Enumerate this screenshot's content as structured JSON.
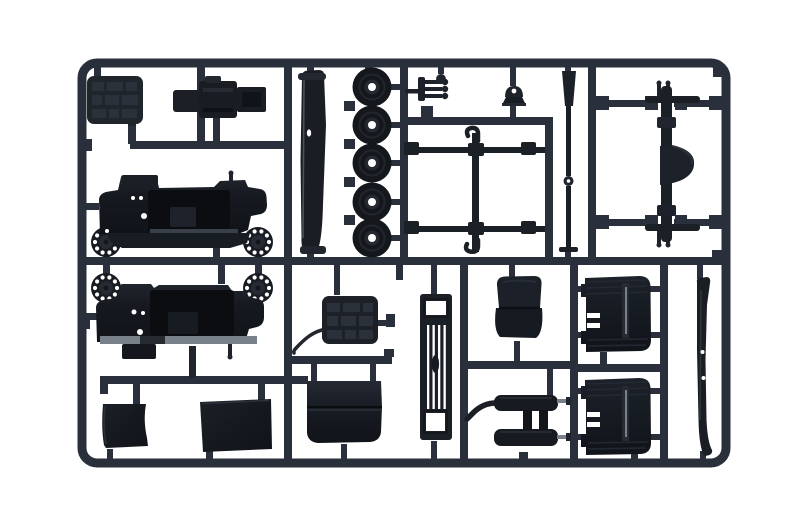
{
  "image": {
    "kind": "product photograph",
    "description": "Injection-moulded plastic model kit sprue (parts tree) in dark grey styrene containing truck parts, shot on a white background",
    "text_visible": "none"
  },
  "colors": {
    "background": "#ffffff",
    "runner": "#2a303b",
    "part_dark": "#16191f",
    "part_mid": "#20252d",
    "part_soft": "#2b313a",
    "edge_light": "#78808a",
    "steel_light": "#8d949d",
    "interior_shadow": "#0b0d10",
    "hole": "#ffffff"
  },
  "sprue": {
    "material": "dark grey styrene plastic",
    "frame_shape": "rounded rectangle with internal runner grid",
    "parts": [
      {
        "id": "tread-plate-panel",
        "label": "textured tread-plate panel",
        "count": 1
      },
      {
        "id": "engine-block",
        "label": "engine block assembly",
        "count": 1
      },
      {
        "id": "windscreen-frame",
        "label": "long curved windscreen/panel strip",
        "count": 1
      },
      {
        "id": "road-wheel",
        "label": "road wheel with open hub",
        "count": 5
      },
      {
        "id": "steering-linkage",
        "label": "steering linkage with three ball pins",
        "count": 1
      },
      {
        "id": "gear-lever",
        "label": "gear lever with ball knob",
        "count": 1
      },
      {
        "id": "horn-bell",
        "label": "bell-shaped horn/lamp",
        "count": 1
      },
      {
        "id": "tow-hook-frame",
        "label": "tie rods with double tow hook bar",
        "count": 1
      },
      {
        "id": "drive-shaft",
        "label": "tapered drive shaft with joint",
        "count": 1
      },
      {
        "id": "rear-axle",
        "label": "rear axle with differential housing and leaf-spring bars",
        "count": 1
      },
      {
        "id": "wheel-hub-cap",
        "label": "brake drum / hub cap with bolt holes",
        "count": 4
      },
      {
        "id": "cab-shell",
        "label": "truck cab body shell",
        "count": 2
      },
      {
        "id": "battery-panel",
        "label": "textured battery/hood panel with cable",
        "count": 1
      },
      {
        "id": "engine-hood",
        "label": "engine hood panel",
        "count": 1
      },
      {
        "id": "radiator-grille",
        "label": "radiator grille with vertical slats",
        "count": 1
      },
      {
        "id": "seat",
        "label": "bench seat",
        "count": 1
      },
      {
        "id": "muffler-assembly",
        "label": "twin muffler / fuel tank assembly with exhaust pipe",
        "count": 1
      },
      {
        "id": "door-panel",
        "label": "cab door panel with window channel",
        "count": 2
      },
      {
        "id": "side-step",
        "label": "long curved side-step strip",
        "count": 1
      },
      {
        "id": "fender-panel",
        "label": "flat fender / mudflap panel",
        "count": 2
      }
    ]
  }
}
